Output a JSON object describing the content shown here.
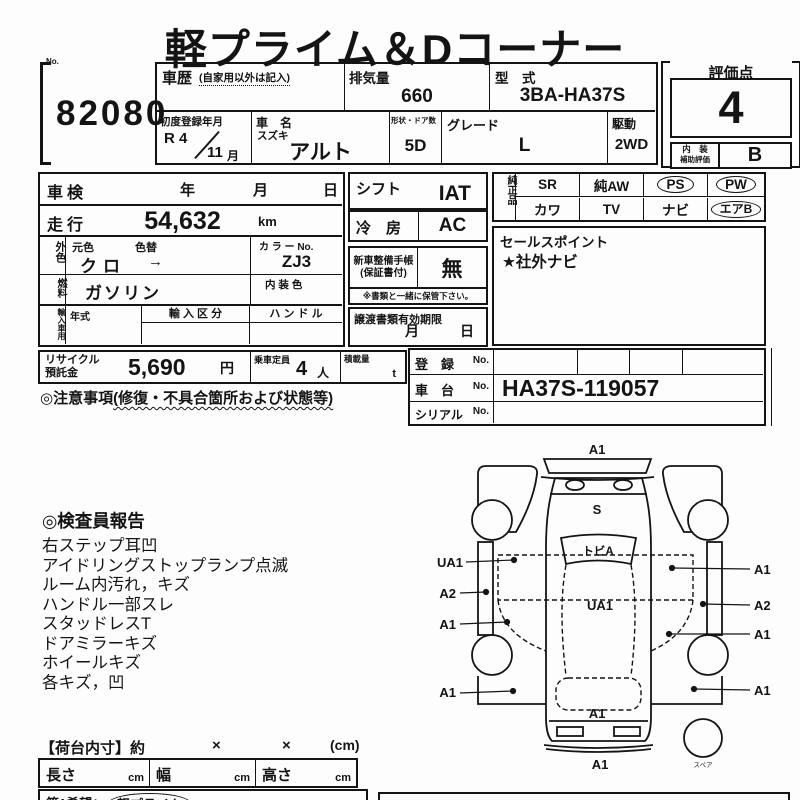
{
  "title": "軽プライム＆Dコーナー",
  "lot": {
    "no_label": "No.",
    "number": "82080"
  },
  "header": {
    "history_label": "車歴",
    "history_note": "(自家用以外は記入)",
    "displacement_label": "排気量",
    "displacement_value": "660",
    "model_label": "型　式",
    "model_value": "3BA-HA37S",
    "first_reg_label": "初度登録年月",
    "first_reg_era": "R 4",
    "first_reg_month": "11",
    "first_reg_month_unit": "月",
    "car_name_label": "車　名",
    "maker": "スズキ",
    "car_name": "アルト",
    "body_doors_label": "形状・ドア数",
    "body_doors_value": "5D",
    "grade_label": "グレード",
    "grade_value": "L",
    "drive_label": "駆動",
    "drive_value": "2WD"
  },
  "score": {
    "label": "評価点",
    "value": "4",
    "interior_label_line1": "内　装",
    "interior_label_line2": "補助評価",
    "interior_value": "B"
  },
  "left_table": {
    "shaken_label": "車検",
    "year_char": "年",
    "month_char": "月",
    "day_char": "日",
    "mileage_label": "走行",
    "mileage_value": "54,632",
    "mileage_unit": "km",
    "ext_color_label": "外色",
    "orig_color_label": "元色",
    "color_change_label": "色替",
    "orig_color_value": "クロ",
    "color_change_arrow": "→",
    "color_no_label": "カ ラ ー No.",
    "color_no_value": "ZJ3",
    "fuel_label": "燃料",
    "fuel_value": "ガソリン",
    "interior_color_label": "内 装 色",
    "import_label": "輸入車用",
    "year_model_label": "年式",
    "import_class_label": "輸 入 区 分",
    "handle_label": "ハ ン ド ル"
  },
  "recycle": {
    "label_line1": "リサイクル",
    "label_line2": "預託金",
    "value": "5,690",
    "unit": "円",
    "capacity_label": "乗車定員",
    "capacity_value": "4",
    "capacity_unit": "人",
    "load_label": "積載量",
    "load_unit": "t"
  },
  "notes": {
    "heading": "◎注意事項",
    "heading_paren": "(修復・不具合箇所および状態等)"
  },
  "middle": {
    "shift_label": "シフト",
    "shift_value": "IAT",
    "ac_label": "冷　房",
    "ac_value": "AC",
    "booklet_label_line1": "新車整備手帳",
    "booklet_label_line2": "(保証書付)",
    "booklet_value": "無",
    "booklet_note": "※書類と一緒に保管下さい。",
    "transfer_label": "譲渡書類有効期限",
    "transfer_month": "月",
    "transfer_day": "日"
  },
  "equipment": {
    "group_label": "純正品",
    "row1": [
      {
        "label": "SR",
        "circled": false
      },
      {
        "label": "純AW",
        "circled": false
      },
      {
        "label": "PS",
        "circled": true
      },
      {
        "label": "PW",
        "circled": true
      }
    ],
    "row2": [
      {
        "label": "カワ",
        "circled": false
      },
      {
        "label": "TV",
        "circled": false
      },
      {
        "label": "ナビ",
        "circled": false
      },
      {
        "label": "エアB",
        "circled": true
      }
    ]
  },
  "sales_point": {
    "label": "セールスポイント",
    "value": "★社外ナビ"
  },
  "registration": {
    "reg_label": "登　録",
    "chassis_label": "車　台",
    "serial_label": "シリアル",
    "no_suffix": "No.",
    "reg_value": "",
    "chassis_value": "HA37S-119057",
    "serial_value": ""
  },
  "inspector": {
    "title": "◎検査員報告",
    "items": [
      "右ステップ耳凹",
      "アイドリングストップランプ点滅",
      "ルーム内汚れ，キズ",
      "ハンドル一部スレ",
      "スタッドレスT",
      "ドアミラーキズ",
      "ホイールキズ",
      "各キズ，凹"
    ]
  },
  "diagram": {
    "front_bumper": "A1",
    "hood": "S",
    "windshield": "トビA",
    "roof": "UA1",
    "left_labels": [
      "UA1",
      "A2",
      "A1",
      "A1"
    ],
    "right_labels": [
      "A1",
      "A2",
      "A1",
      "A1"
    ],
    "tailgate": "A1",
    "rear_bumper": "A1",
    "spare": "スペア"
  },
  "cargo": {
    "title": "【荷台内寸】約",
    "times1": "×",
    "times2": "×",
    "unit": "(cm)",
    "length_label": "長さ",
    "length_unit": "cm",
    "width_label": "幅",
    "width_unit": "cm",
    "height_label": "高さ",
    "height_unit": "cm",
    "preference_label": "第1希望：",
    "preference_value": "軽プライム"
  }
}
